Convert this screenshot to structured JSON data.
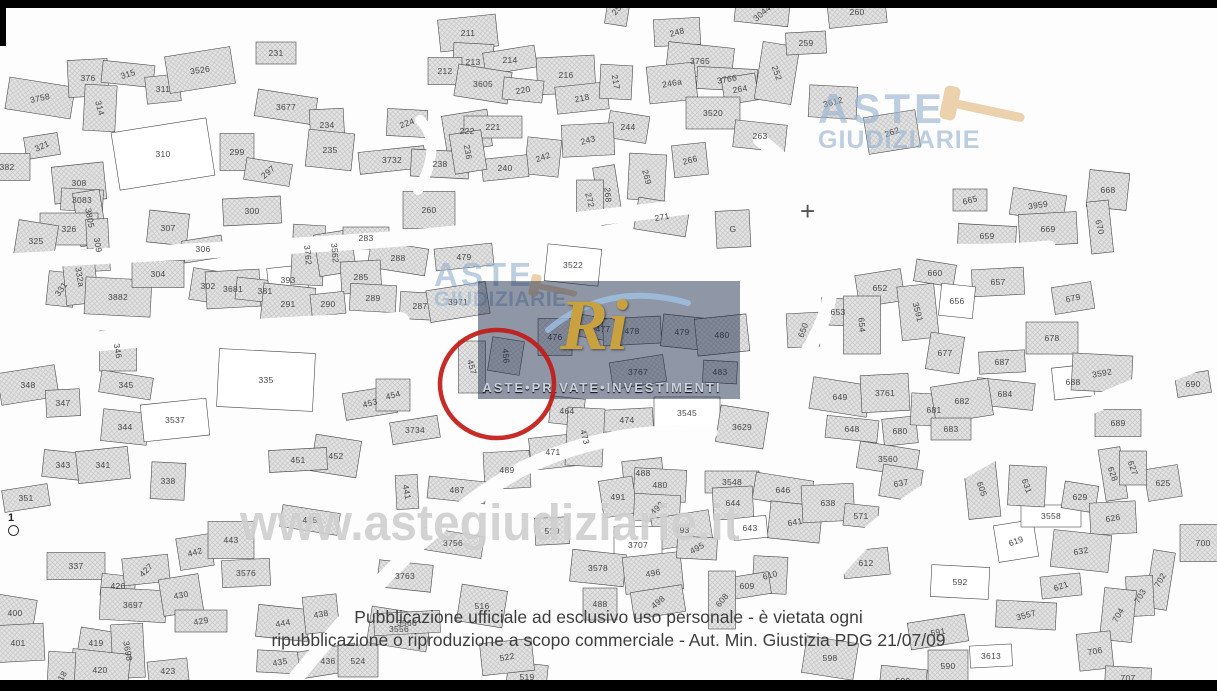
{
  "watermarks": {
    "site": "www.astegiudiziarie.it",
    "brand_top_right": {
      "line1": "ASTE",
      "line2": "GIUDIZIARIE"
    },
    "brand_center": {
      "line1": "ASTE",
      "line2": "GIUDIZIARIE"
    },
    "api_logo": {
      "monogram": "Ri",
      "caption": "ASTE•PRIVATE•INVESTIMENTI"
    }
  },
  "disclaimer": {
    "line1": "Pubblicazione ufficiale ad esclusivo uso personale - è vietata ogni",
    "line2": "ripubblicazione o riproduzione a scopo commerciale - Aut. Min. Giustizia PDG 21/07/09"
  },
  "highlight": {
    "parcel": "490",
    "cx": 497,
    "cy": 384,
    "rx": 57,
    "ry": 54,
    "color": "#c11b17"
  },
  "benchmark": {
    "label": "1"
  },
  "map": {
    "white_parcels": [
      "310",
      "3537",
      "3522",
      "393",
      "656",
      "3558",
      "592",
      "619",
      "643",
      "3707",
      "335",
      "3545",
      "688",
      "592",
      "3613"
    ],
    "parcels": [
      {
        "n": "321",
        "x": 42,
        "y": 146,
        "r": -25
      },
      {
        "n": "382",
        "x": 7,
        "y": 167
      },
      {
        "n": "3758",
        "x": 40,
        "y": 98,
        "r": -12
      },
      {
        "n": "376",
        "x": 88,
        "y": 78
      },
      {
        "n": "315",
        "x": 128,
        "y": 74,
        "r": -18
      },
      {
        "n": "311",
        "x": 163,
        "y": 89
      },
      {
        "n": "314",
        "x": 100,
        "y": 108,
        "r": 75
      },
      {
        "n": "3526",
        "x": 200,
        "y": 70,
        "r": -8
      },
      {
        "n": "231",
        "x": 276,
        "y": 53
      },
      {
        "n": "3677",
        "x": 286,
        "y": 107
      },
      {
        "n": "234",
        "x": 327,
        "y": 125
      },
      {
        "n": "235",
        "x": 330,
        "y": 150
      },
      {
        "n": "3732",
        "x": 392,
        "y": 160
      },
      {
        "n": "224",
        "x": 407,
        "y": 123,
        "r": -20
      },
      {
        "n": "310",
        "x": 163,
        "y": 154
      },
      {
        "n": "299",
        "x": 237,
        "y": 152
      },
      {
        "n": "297",
        "x": 268,
        "y": 172,
        "r": -40
      },
      {
        "n": "300",
        "x": 252,
        "y": 211
      },
      {
        "n": "307",
        "x": 168,
        "y": 228
      },
      {
        "n": "308",
        "x": 79,
        "y": 183
      },
      {
        "n": "3083",
        "x": 82,
        "y": 200
      },
      {
        "n": "3805",
        "x": 90,
        "y": 218,
        "r": 80
      },
      {
        "n": "326",
        "x": 69,
        "y": 229
      },
      {
        "n": "325",
        "x": 36,
        "y": 241
      },
      {
        "n": "309",
        "x": 98,
        "y": 245,
        "r": 80
      },
      {
        "n": "331",
        "x": 61,
        "y": 289,
        "r": -55
      },
      {
        "n": "332a",
        "x": 80,
        "y": 277,
        "r": 80
      },
      {
        "n": "3882",
        "x": 118,
        "y": 297
      },
      {
        "n": "306",
        "x": 203,
        "y": 249
      },
      {
        "n": "304",
        "x": 158,
        "y": 274
      },
      {
        "n": "302",
        "x": 208,
        "y": 286
      },
      {
        "n": "3681",
        "x": 233,
        "y": 289
      },
      {
        "n": "381",
        "x": 265,
        "y": 291
      },
      {
        "n": "393",
        "x": 288,
        "y": 280
      },
      {
        "n": "3762",
        "x": 308,
        "y": 255,
        "r": 85
      },
      {
        "n": "3562",
        "x": 335,
        "y": 253,
        "r": 85
      },
      {
        "n": "283",
        "x": 366,
        "y": 238
      },
      {
        "n": "288",
        "x": 398,
        "y": 258
      },
      {
        "n": "285",
        "x": 361,
        "y": 277
      },
      {
        "n": "291",
        "x": 288,
        "y": 304
      },
      {
        "n": "290",
        "x": 328,
        "y": 304
      },
      {
        "n": "289",
        "x": 373,
        "y": 298
      },
      {
        "n": "348",
        "x": 28,
        "y": 385
      },
      {
        "n": "346",
        "x": 118,
        "y": 351,
        "r": 80
      },
      {
        "n": "345",
        "x": 126,
        "y": 385
      },
      {
        "n": "347",
        "x": 63,
        "y": 403
      },
      {
        "n": "344",
        "x": 125,
        "y": 427
      },
      {
        "n": "3537",
        "x": 175,
        "y": 420
      },
      {
        "n": "335",
        "x": 266,
        "y": 380
      },
      {
        "n": "453",
        "x": 370,
        "y": 403,
        "r": -15
      },
      {
        "n": "454",
        "x": 393,
        "y": 395,
        "r": -15
      },
      {
        "n": "452",
        "x": 336,
        "y": 456
      },
      {
        "n": "451",
        "x": 298,
        "y": 460
      },
      {
        "n": "343",
        "x": 63,
        "y": 465
      },
      {
        "n": "341",
        "x": 103,
        "y": 465
      },
      {
        "n": "338",
        "x": 168,
        "y": 481
      },
      {
        "n": "351",
        "x": 26,
        "y": 498
      },
      {
        "n": "337",
        "x": 76,
        "y": 566
      },
      {
        "n": "400",
        "x": 15,
        "y": 613
      },
      {
        "n": "401",
        "x": 18,
        "y": 643
      },
      {
        "n": "426",
        "x": 118,
        "y": 586
      },
      {
        "n": "427",
        "x": 146,
        "y": 570,
        "r": -45
      },
      {
        "n": "3697",
        "x": 133,
        "y": 605
      },
      {
        "n": "430",
        "x": 181,
        "y": 595,
        "r": -10
      },
      {
        "n": "429",
        "x": 201,
        "y": 621,
        "r": -10
      },
      {
        "n": "419",
        "x": 96,
        "y": 643
      },
      {
        "n": "3698",
        "x": 128,
        "y": 651,
        "r": 80
      },
      {
        "n": "420",
        "x": 100,
        "y": 670
      },
      {
        "n": "423",
        "x": 168,
        "y": 671
      },
      {
        "n": "418",
        "x": 61,
        "y": 678,
        "r": -60
      },
      {
        "n": "442",
        "x": 195,
        "y": 552,
        "r": -15
      },
      {
        "n": "443",
        "x": 231,
        "y": 540
      },
      {
        "n": "445",
        "x": 310,
        "y": 520
      },
      {
        "n": "3576",
        "x": 246,
        "y": 573
      },
      {
        "n": "444",
        "x": 283,
        "y": 623,
        "r": -10
      },
      {
        "n": "438",
        "x": 321,
        "y": 614,
        "r": -10
      },
      {
        "n": "435",
        "x": 280,
        "y": 662,
        "r": -10
      },
      {
        "n": "436",
        "x": 328,
        "y": 661
      },
      {
        "n": "524",
        "x": 358,
        "y": 661
      },
      {
        "n": "3556",
        "x": 399,
        "y": 629
      },
      {
        "n": "441",
        "x": 407,
        "y": 492,
        "r": 80
      },
      {
        "n": "3763",
        "x": 405,
        "y": 576
      },
      {
        "n": "211",
        "x": 468,
        "y": 33
      },
      {
        "n": "213",
        "x": 473,
        "y": 62
      },
      {
        "n": "214",
        "x": 510,
        "y": 60
      },
      {
        "n": "212",
        "x": 445,
        "y": 71
      },
      {
        "n": "3605",
        "x": 483,
        "y": 84
      },
      {
        "n": "216",
        "x": 566,
        "y": 75
      },
      {
        "n": "220",
        "x": 523,
        "y": 90,
        "r": -10
      },
      {
        "n": "218",
        "x": 582,
        "y": 98,
        "r": -12
      },
      {
        "n": "217",
        "x": 616,
        "y": 82,
        "r": 80
      },
      {
        "n": "222",
        "x": 467,
        "y": 131
      },
      {
        "n": "221",
        "x": 493,
        "y": 127
      },
      {
        "n": "244",
        "x": 628,
        "y": 127
      },
      {
        "n": "243",
        "x": 588,
        "y": 140,
        "r": -15
      },
      {
        "n": "242",
        "x": 543,
        "y": 157,
        "r": -20
      },
      {
        "n": "240",
        "x": 505,
        "y": 168
      },
      {
        "n": "238",
        "x": 440,
        "y": 164
      },
      {
        "n": "236",
        "x": 468,
        "y": 152,
        "r": 80
      },
      {
        "n": "260",
        "x": 429,
        "y": 210
      },
      {
        "n": "250",
        "x": 618,
        "y": 8,
        "r": -50
      },
      {
        "n": "248",
        "x": 677,
        "y": 32,
        "r": -15
      },
      {
        "n": "3765",
        "x": 700,
        "y": 61
      },
      {
        "n": "246a",
        "x": 672,
        "y": 83,
        "r": -10
      },
      {
        "n": "3766",
        "x": 727,
        "y": 79,
        "r": -10
      },
      {
        "n": "264",
        "x": 740,
        "y": 89,
        "r": -10
      },
      {
        "n": "3520",
        "x": 713,
        "y": 113
      },
      {
        "n": "252",
        "x": 777,
        "y": 73,
        "r": 70
      },
      {
        "n": "259",
        "x": 806,
        "y": 43
      },
      {
        "n": "263",
        "x": 760,
        "y": 136
      },
      {
        "n": "266",
        "x": 690,
        "y": 160,
        "r": -15
      },
      {
        "n": "269",
        "x": 647,
        "y": 177,
        "r": 75
      },
      {
        "n": "268",
        "x": 608,
        "y": 195,
        "r": 85
      },
      {
        "n": "272",
        "x": 590,
        "y": 200,
        "r": 75
      },
      {
        "n": "271",
        "x": 662,
        "y": 217,
        "r": -10
      },
      {
        "n": "G",
        "x": 733,
        "y": 229
      },
      {
        "n": "3044",
        "x": 762,
        "y": 13,
        "r": -40
      },
      {
        "n": "260",
        "x": 857,
        "y": 12
      },
      {
        "n": "3612",
        "x": 833,
        "y": 102,
        "r": -15
      },
      {
        "n": "262",
        "x": 892,
        "y": 132,
        "r": -20
      },
      {
        "n": "665",
        "x": 970,
        "y": 200,
        "r": -15
      },
      {
        "n": "3959",
        "x": 1038,
        "y": 205,
        "r": -8
      },
      {
        "n": "669",
        "x": 1048,
        "y": 229
      },
      {
        "n": "668",
        "x": 1108,
        "y": 190
      },
      {
        "n": "670",
        "x": 1100,
        "y": 227,
        "r": 75
      },
      {
        "n": "653",
        "x": 838,
        "y": 312
      },
      {
        "n": "652",
        "x": 880,
        "y": 288
      },
      {
        "n": "654",
        "x": 862,
        "y": 325,
        "r": 85
      },
      {
        "n": "660",
        "x": 935,
        "y": 273
      },
      {
        "n": "657",
        "x": 998,
        "y": 282
      },
      {
        "n": "656",
        "x": 957,
        "y": 301
      },
      {
        "n": "3591",
        "x": 918,
        "y": 312,
        "r": 75
      },
      {
        "n": "659",
        "x": 987,
        "y": 236
      },
      {
        "n": "679",
        "x": 1073,
        "y": 298,
        "r": -12
      },
      {
        "n": "678",
        "x": 1052,
        "y": 338
      },
      {
        "n": "677",
        "x": 945,
        "y": 353
      },
      {
        "n": "687",
        "x": 1002,
        "y": 362
      },
      {
        "n": "684",
        "x": 1005,
        "y": 394
      },
      {
        "n": "688",
        "x": 1073,
        "y": 382
      },
      {
        "n": "3592",
        "x": 1102,
        "y": 373,
        "r": -10
      },
      {
        "n": "690",
        "x": 1193,
        "y": 384
      },
      {
        "n": "689",
        "x": 1118,
        "y": 423
      },
      {
        "n": "649",
        "x": 840,
        "y": 397
      },
      {
        "n": "3761",
        "x": 885,
        "y": 393
      },
      {
        "n": "648",
        "x": 852,
        "y": 429
      },
      {
        "n": "680",
        "x": 900,
        "y": 431
      },
      {
        "n": "681",
        "x": 934,
        "y": 410
      },
      {
        "n": "682",
        "x": 962,
        "y": 401
      },
      {
        "n": "683",
        "x": 951,
        "y": 429
      },
      {
        "n": "3560",
        "x": 888,
        "y": 459
      },
      {
        "n": "650",
        "x": 803,
        "y": 330,
        "r": -70
      },
      {
        "n": "3522",
        "x": 573,
        "y": 265
      },
      {
        "n": "479",
        "x": 464,
        "y": 257
      },
      {
        "n": "287",
        "x": 420,
        "y": 306
      },
      {
        "n": "3971",
        "x": 458,
        "y": 302
      },
      {
        "n": "476",
        "x": 555,
        "y": 337
      },
      {
        "n": "477",
        "x": 603,
        "y": 329
      },
      {
        "n": "478",
        "x": 632,
        "y": 331
      },
      {
        "n": "479",
        "x": 682,
        "y": 332
      },
      {
        "n": "480",
        "x": 722,
        "y": 335
      },
      {
        "n": "483",
        "x": 720,
        "y": 372
      },
      {
        "n": "3767",
        "x": 638,
        "y": 372
      },
      {
        "n": "3545",
        "x": 687,
        "y": 413
      },
      {
        "n": "3629",
        "x": 742,
        "y": 427
      },
      {
        "n": "474",
        "x": 627,
        "y": 420
      },
      {
        "n": "464",
        "x": 567,
        "y": 411
      },
      {
        "n": "471",
        "x": 553,
        "y": 452
      },
      {
        "n": "473",
        "x": 585,
        "y": 437,
        "r": 75
      },
      {
        "n": "3734",
        "x": 415,
        "y": 430
      },
      {
        "n": "457",
        "x": 472,
        "y": 367,
        "r": 75
      },
      {
        "n": "456",
        "x": 506,
        "y": 356,
        "r": 85
      },
      {
        "n": "489",
        "x": 507,
        "y": 470
      },
      {
        "n": "487",
        "x": 457,
        "y": 490
      },
      {
        "n": "488",
        "x": 643,
        "y": 473
      },
      {
        "n": "480",
        "x": 660,
        "y": 485
      },
      {
        "n": "491",
        "x": 618,
        "y": 497
      },
      {
        "n": "3548",
        "x": 732,
        "y": 482
      },
      {
        "n": "646",
        "x": 783,
        "y": 490
      },
      {
        "n": "644",
        "x": 733,
        "y": 503
      },
      {
        "n": "641",
        "x": 795,
        "y": 522,
        "r": -10
      },
      {
        "n": "643",
        "x": 750,
        "y": 528
      },
      {
        "n": "492",
        "x": 657,
        "y": 508,
        "r": -45
      },
      {
        "n": "493",
        "x": 682,
        "y": 530
      },
      {
        "n": "3707",
        "x": 638,
        "y": 545
      },
      {
        "n": "3756",
        "x": 453,
        "y": 543
      },
      {
        "n": "520",
        "x": 552,
        "y": 531
      },
      {
        "n": "3578",
        "x": 598,
        "y": 568
      },
      {
        "n": "496",
        "x": 653,
        "y": 573,
        "r": -10
      },
      {
        "n": "495",
        "x": 697,
        "y": 548,
        "r": -30
      },
      {
        "n": "498",
        "x": 658,
        "y": 602,
        "r": -40
      },
      {
        "n": "488",
        "x": 600,
        "y": 604
      },
      {
        "n": "516",
        "x": 482,
        "y": 606
      },
      {
        "n": "3566",
        "x": 407,
        "y": 623
      },
      {
        "n": "519",
        "x": 527,
        "y": 677
      },
      {
        "n": "522",
        "x": 507,
        "y": 657,
        "r": -10
      },
      {
        "n": "610",
        "x": 770,
        "y": 575,
        "r": -15
      },
      {
        "n": "609",
        "x": 747,
        "y": 586
      },
      {
        "n": "608",
        "x": 722,
        "y": 600,
        "r": -50
      },
      {
        "n": "637",
        "x": 901,
        "y": 483,
        "r": -10
      },
      {
        "n": "638",
        "x": 828,
        "y": 503
      },
      {
        "n": "571",
        "x": 861,
        "y": 516
      },
      {
        "n": "612",
        "x": 866,
        "y": 563
      },
      {
        "n": "592",
        "x": 960,
        "y": 582
      },
      {
        "n": "619",
        "x": 1016,
        "y": 541,
        "r": -20
      },
      {
        "n": "3558",
        "x": 1051,
        "y": 516
      },
      {
        "n": "629",
        "x": 1080,
        "y": 497
      },
      {
        "n": "626",
        "x": 1113,
        "y": 518,
        "r": -10
      },
      {
        "n": "632",
        "x": 1081,
        "y": 551,
        "r": -10
      },
      {
        "n": "621",
        "x": 1061,
        "y": 586,
        "r": -20
      },
      {
        "n": "3557",
        "x": 1026,
        "y": 615,
        "r": -15
      },
      {
        "n": "625",
        "x": 1163,
        "y": 483
      },
      {
        "n": "700",
        "x": 1203,
        "y": 543
      },
      {
        "n": "702",
        "x": 1160,
        "y": 580,
        "r": -60
      },
      {
        "n": "703",
        "x": 1140,
        "y": 596,
        "r": -60
      },
      {
        "n": "704",
        "x": 1118,
        "y": 615,
        "r": -60
      },
      {
        "n": "706",
        "x": 1095,
        "y": 651,
        "r": -10
      },
      {
        "n": "707",
        "x": 1128,
        "y": 678
      },
      {
        "n": "591",
        "x": 938,
        "y": 632,
        "r": -10
      },
      {
        "n": "590",
        "x": 948,
        "y": 666
      },
      {
        "n": "598",
        "x": 830,
        "y": 658
      },
      {
        "n": "3613",
        "x": 991,
        "y": 656
      },
      {
        "n": "599",
        "x": 903,
        "y": 681
      },
      {
        "n": "605",
        "x": 982,
        "y": 489,
        "r": 70
      },
      {
        "n": "631",
        "x": 1027,
        "y": 486,
        "r": 70
      },
      {
        "n": "628",
        "x": 1113,
        "y": 474,
        "r": 70
      },
      {
        "n": "627",
        "x": 1133,
        "y": 468,
        "r": 70
      }
    ]
  }
}
